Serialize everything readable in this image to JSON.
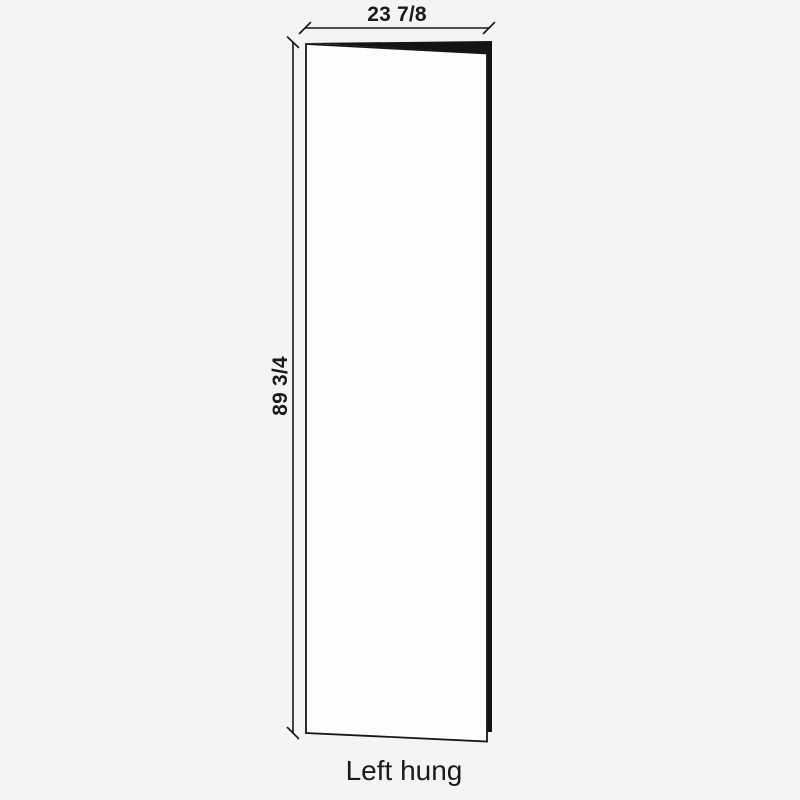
{
  "diagram": {
    "type_label": "Left hung",
    "dimensions": {
      "width": "23 7/8",
      "height": "89 3/4"
    },
    "colors": {
      "background": "#f4f4f6",
      "door_face": "#fdfdfe",
      "door_edge": "#141414",
      "outline": "#161616",
      "text": "#1a1a1a"
    }
  }
}
